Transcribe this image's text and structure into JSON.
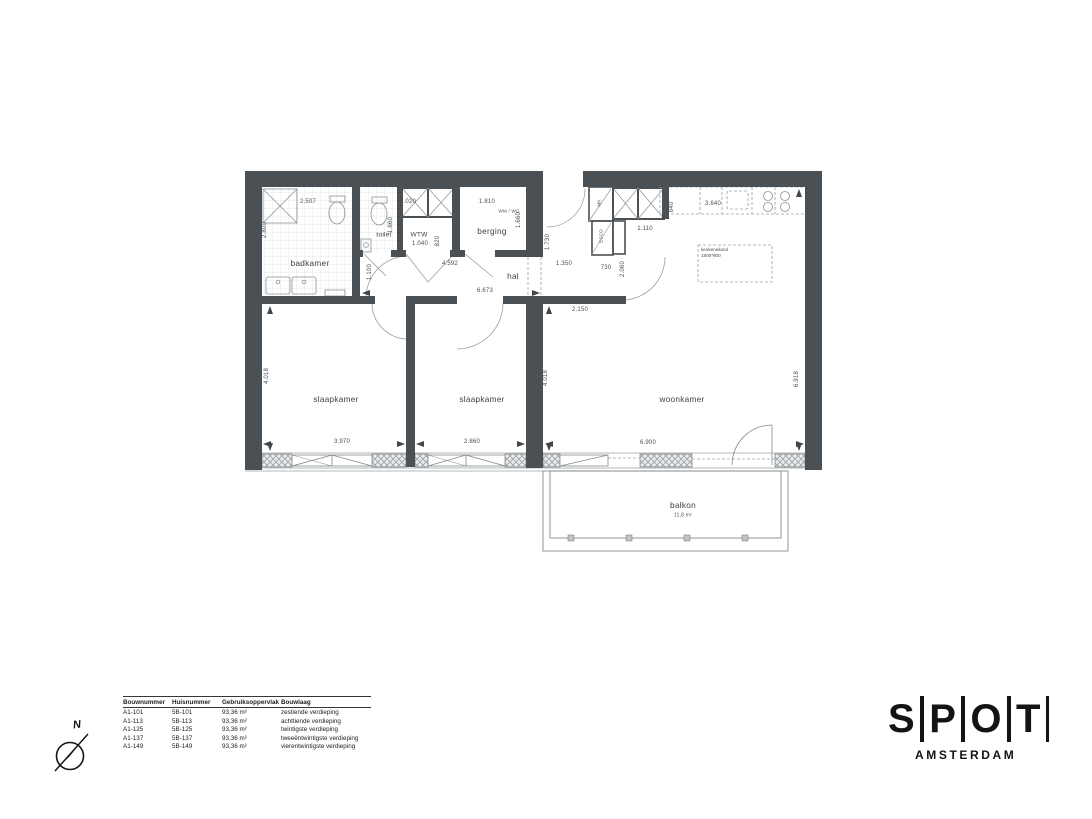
{
  "plan": {
    "rooms": {
      "badkamer": "badkamer",
      "toilet": "toilet",
      "wtw": "WTW",
      "berging": "berging",
      "hal": "hal",
      "slaapkamer_1": "slaapkamer",
      "slaapkamer_2": "slaapkamer",
      "woonkamer": "woonkamer",
      "balkon": "balkon",
      "balkon_area": "11,8 m²",
      "mk": "MK",
      "esco": "ESCO",
      "wm_wg": "WM / WG",
      "keukeneiland_line1": "keukeneiland",
      "keukeneiland_line2": "1800*900"
    },
    "dimensions": {
      "badkamer_w": "2.507",
      "badkamer_h": "2.800",
      "toilet_w": "1.020",
      "toilet_h": "1.660",
      "wtw_w": "1.040",
      "wtw_d": "820",
      "berging_w": "1.810",
      "berging_h": "1.660",
      "badkamer_deur": "1.100",
      "hal_l1": "4.592",
      "hal_l2": "6.673",
      "entree_d": "1.730",
      "entree_w": "1.350",
      "kast_w": "730",
      "kast_l": "1.110",
      "aanrecht_d": "840",
      "keuken_l": "3.640",
      "deur_h": "2.060",
      "entree_l": "2.150",
      "slaapkamer_d": "4.018",
      "slaapkamer1_w": "3.970",
      "slaapkamer2_w": "2.860",
      "woonkamer_d": "4.018",
      "woonkamer_w": "6.900",
      "woonkamer_h": "6.918"
    }
  },
  "legend_table": {
    "headers": [
      "Bouwnummer",
      "Huisnummer",
      "Gebruiksoppervlak",
      "Bouwlaag"
    ],
    "rows": [
      [
        "A1-101",
        "5B-101",
        "93,36 m²",
        "zestiende verdieping"
      ],
      [
        "A1-113",
        "5B-113",
        "93,36 m²",
        "achttiende verdieping"
      ],
      [
        "A1-125",
        "5B-125",
        "93,36 m²",
        "twintigste verdieping"
      ],
      [
        "A1-137",
        "5B-137",
        "93,36 m²",
        "tweeëntwintigste verdieping"
      ],
      [
        "A1-149",
        "5B-149",
        "93,36 m²",
        "vierentwintigste verdieping"
      ]
    ]
  },
  "logo": {
    "letters": [
      "S",
      "P",
      "O",
      "T"
    ],
    "subtitle": "AMSTERDAM"
  },
  "compass": {
    "north_label": "N"
  },
  "colors": {
    "wall": "#4b5055",
    "line": "#85898c",
    "dim_text": "#4a4e52",
    "logo_black": "#141414"
  }
}
